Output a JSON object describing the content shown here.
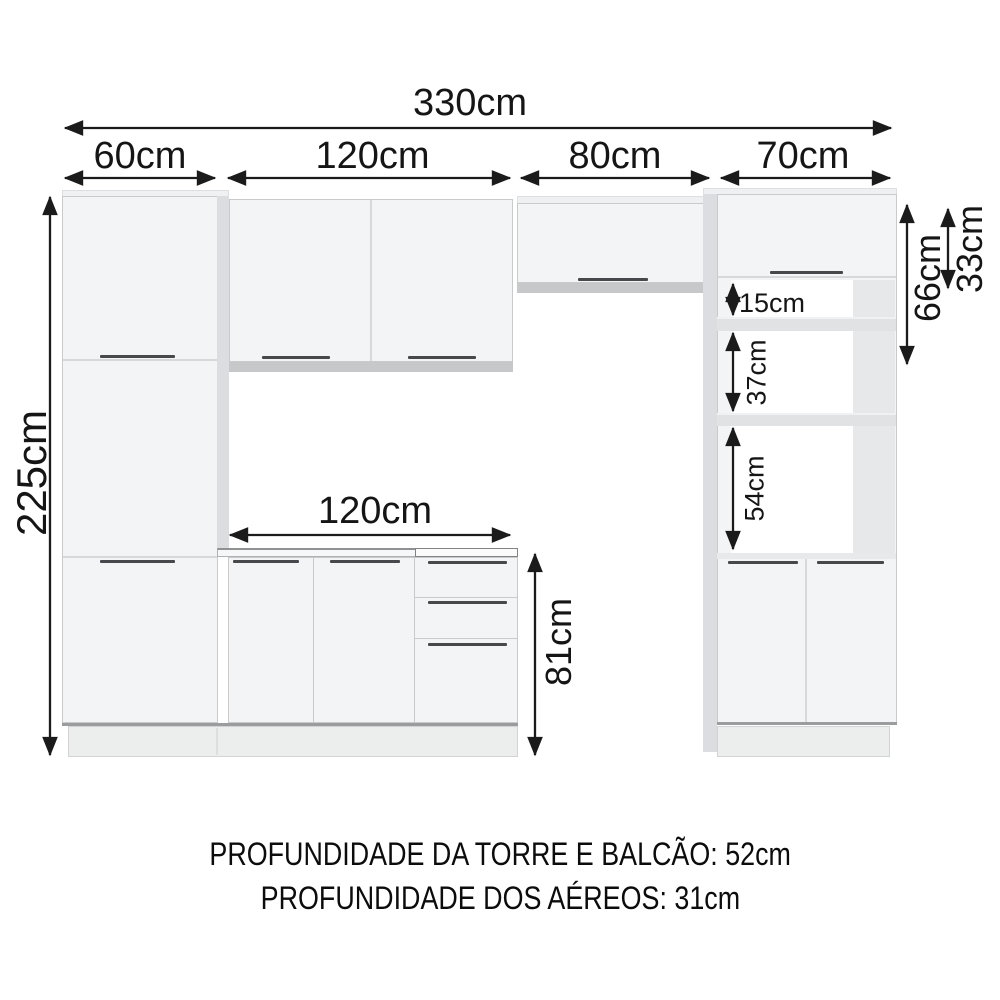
{
  "diagram": {
    "type": "kitchen-cabinet-dimension-drawing",
    "units": "cm"
  },
  "dims": {
    "d330": {
      "label": "330cm"
    },
    "d60": {
      "label": "60cm"
    },
    "d120_top": {
      "label": "120cm"
    },
    "d80": {
      "label": "80cm"
    },
    "d70": {
      "label": "70cm"
    },
    "d225": {
      "label": "225cm"
    },
    "d120_counter": {
      "label": "120cm"
    },
    "d81": {
      "label": "81cm"
    },
    "d15": {
      "label": "15cm"
    },
    "d37": {
      "label": "37cm"
    },
    "d54": {
      "label": "54cm"
    },
    "d66": {
      "label": "66cm"
    },
    "d33": {
      "label": "33cm"
    }
  },
  "footer": {
    "line1": "PROFUNDIDADE DA TORRE E BALCÃO: 52cm",
    "line2": "PROFUNDIDADE DOS AÉREOS: 31cm"
  },
  "colors": {
    "background": "#ffffff",
    "dimension_line": "#1b1b1b",
    "cabinet_front": "#f3f4f5",
    "cabinet_side": "#dcdde0",
    "cabinet_bottom_strip": "#c7c8ca",
    "handle": "#47484c",
    "plinth": "#eceded"
  }
}
